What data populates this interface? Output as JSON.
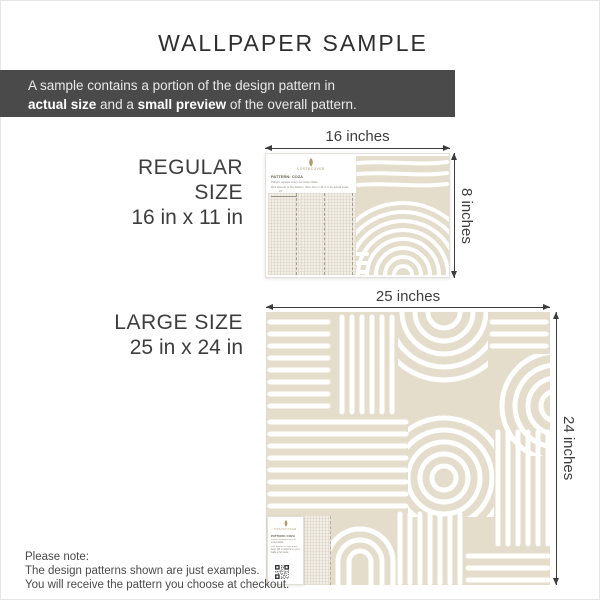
{
  "title": "WALLPAPER SAMPLE",
  "banner": {
    "line1": "A sample contains a portion of the design pattern in",
    "bold1": "actual size",
    "mid1": " and a ",
    "bold2": "small preview",
    "end": " of the overall pattern."
  },
  "brand": "COSTACOVER",
  "regular": {
    "heading": "REGULAR SIZE",
    "dimensions": "16 in x 11 in",
    "width_label": "16 inches",
    "height_label": "8 inches",
    "card": {
      "pattern_name": "PATTERN: COZA",
      "note1": "Pattern repeats every 24 inches Wide.",
      "note2": "Mini artwork of the Pattern, Size 16 in x 11 in in its actual scale.",
      "repeat_label": "24\""
    }
  },
  "large": {
    "heading": "LARGE SIZE",
    "dimensions": "25 in x 24 in",
    "width_label": "25 inches",
    "height_label": "24 inches",
    "card": {
      "pattern_name": "PATTERN: COZA",
      "note1": "Pattern repeats every 24 inches Wide.",
      "note2": "Mini artwork of the Pattern. Scan QR to watch it on your walls at full scale."
    }
  },
  "footer": {
    "line1": "Please note:",
    "line2": "The design patterns shown are just examples.",
    "line3": "You will receive the pattern you choose at checkout."
  },
  "colors": {
    "banner_bg": "#4a4a4a",
    "pattern_beige": "#e5ddcb",
    "text_dark": "#3d3d3d",
    "brand_gold": "#a3906a"
  }
}
